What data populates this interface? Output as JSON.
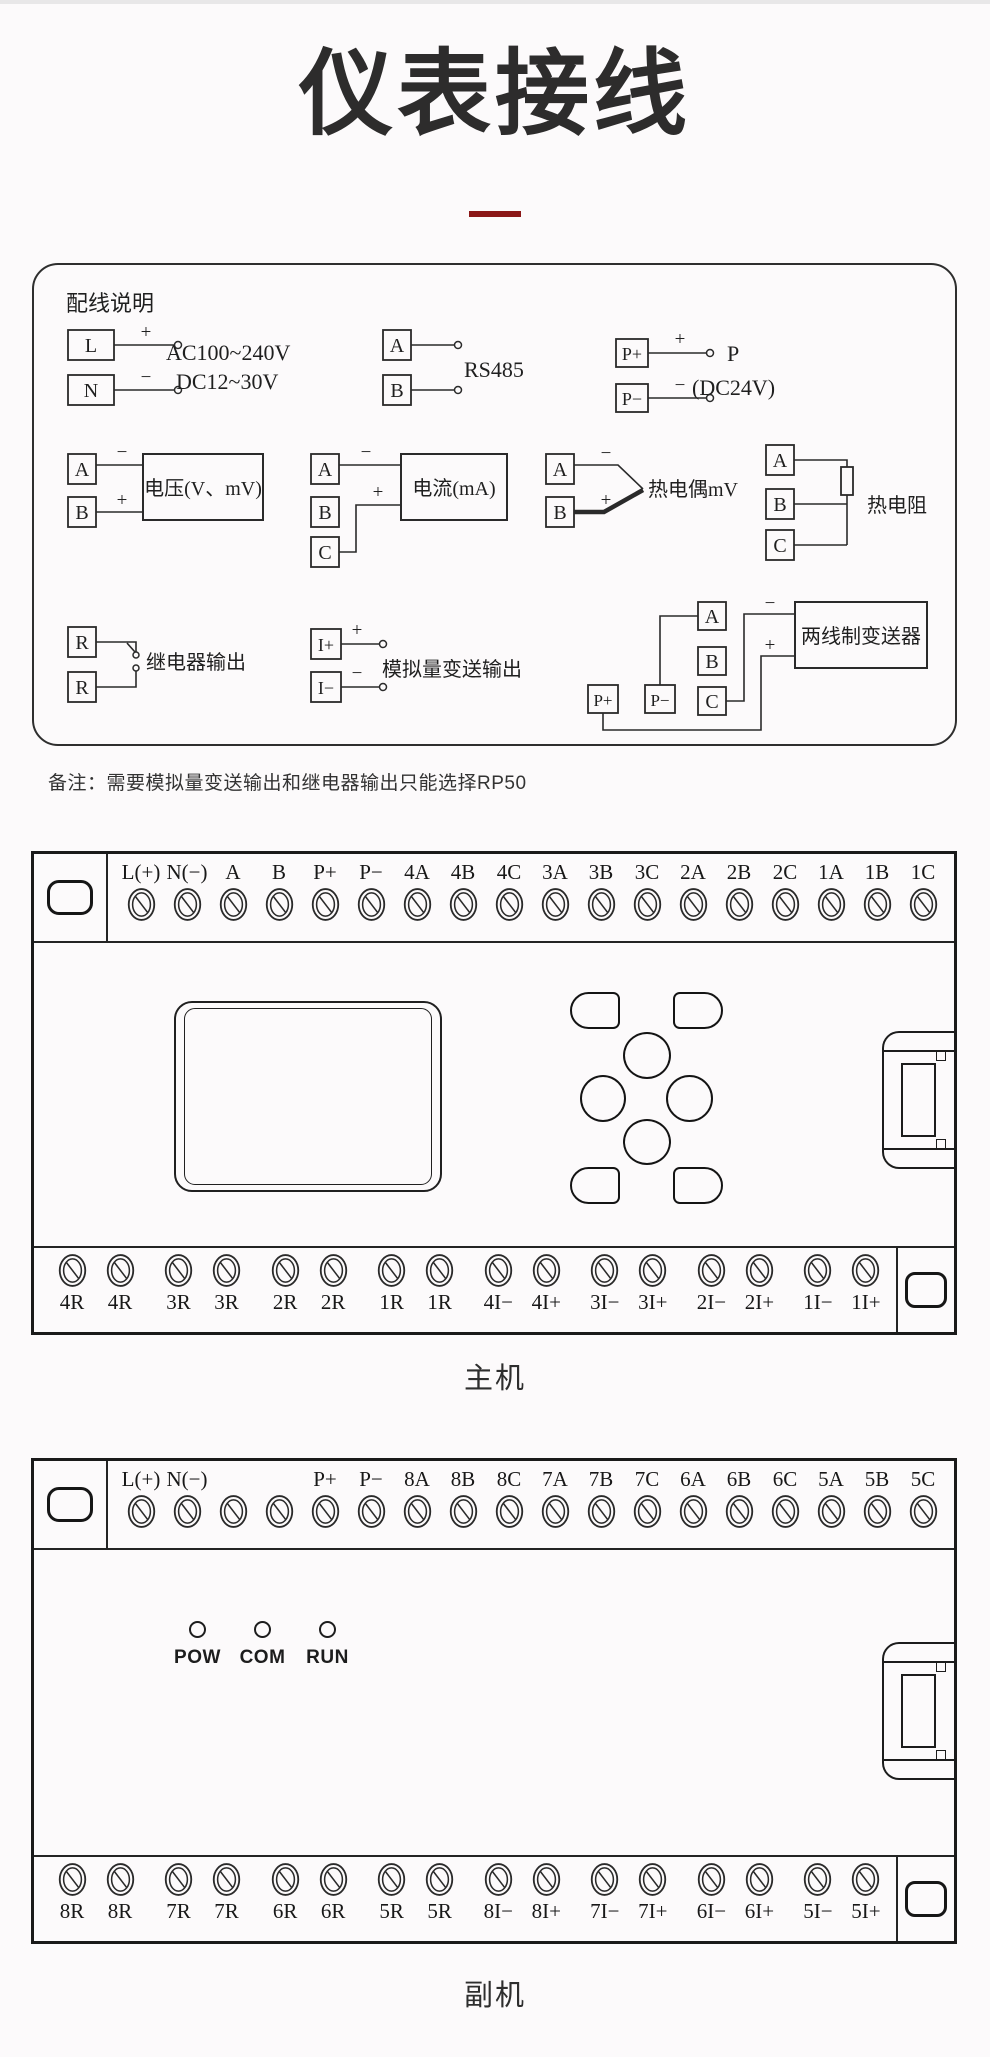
{
  "page": {
    "title": "仪表接线",
    "accent_color": "#8b1717",
    "line_color": "#2a2a2a"
  },
  "wiring_box": {
    "heading": "配线说明",
    "power": {
      "t1": "L",
      "t2": "N",
      "plus": "+",
      "minus": "−",
      "line1": "AC100~240V",
      "line2": "DC12~30V"
    },
    "rs485": {
      "t1": "A",
      "t2": "B",
      "label": "RS485"
    },
    "p24": {
      "t1": "P+",
      "t2": "P−",
      "plus": "+",
      "minus": "−",
      "label1": "P",
      "label2": "(DC24V)"
    },
    "voltage": {
      "t1": "A",
      "t2": "B",
      "minus": "−",
      "plus": "+",
      "label": "电压(V、mV)"
    },
    "current": {
      "t1": "A",
      "t2": "B",
      "t3": "C",
      "minus": "−",
      "plus": "+",
      "label": "电流(mA)"
    },
    "thermocouple": {
      "t1": "A",
      "t2": "B",
      "minus": "−",
      "plus": "+",
      "label": "热电偶mV"
    },
    "rtd": {
      "t1": "A",
      "t2": "B",
      "t3": "C",
      "label": "热电阻"
    },
    "relay": {
      "t1": "R",
      "t2": "R",
      "label": "继电器输出"
    },
    "analog": {
      "t1": "I+",
      "t2": "I−",
      "plus": "+",
      "minus": "−",
      "label": "模拟量变送输出"
    },
    "transmitter": {
      "p1": "P+",
      "p2": "P−",
      "t1": "A",
      "t2": "B",
      "t3": "C",
      "minus": "−",
      "plus": "+",
      "label": "两线制变送器"
    }
  },
  "note": "备注：需要模拟量变送输出和继电器输出只能选择RP50",
  "main_unit": {
    "label": "主机",
    "top_terminals": [
      "L(+)",
      "N(−)",
      "A",
      "B",
      "P+",
      "P−",
      "4A",
      "4B",
      "4C",
      "3A",
      "3B",
      "3C",
      "2A",
      "2B",
      "2C",
      "1A",
      "1B",
      "1C"
    ],
    "bottom_terminals": [
      "4R",
      "4R",
      "3R",
      "3R",
      "2R",
      "2R",
      "1R",
      "1R",
      "4I−",
      "4I+",
      "3I−",
      "3I+",
      "2I−",
      "2I+",
      "1I−",
      "1I+"
    ]
  },
  "sub_unit": {
    "label": "副机",
    "top_terminals": [
      "L(+)",
      "N(−)",
      "",
      "",
      "P+",
      "P−",
      "8A",
      "8B",
      "8C",
      "7A",
      "7B",
      "7C",
      "6A",
      "6B",
      "6C",
      "5A",
      "5B",
      "5C"
    ],
    "bottom_terminals": [
      "8R",
      "8R",
      "7R",
      "7R",
      "6R",
      "6R",
      "5R",
      "5R",
      "8I−",
      "8I+",
      "7I−",
      "7I+",
      "6I−",
      "6I+",
      "5I−",
      "5I+"
    ],
    "leds": [
      "POW",
      "COM",
      "RUN"
    ]
  }
}
